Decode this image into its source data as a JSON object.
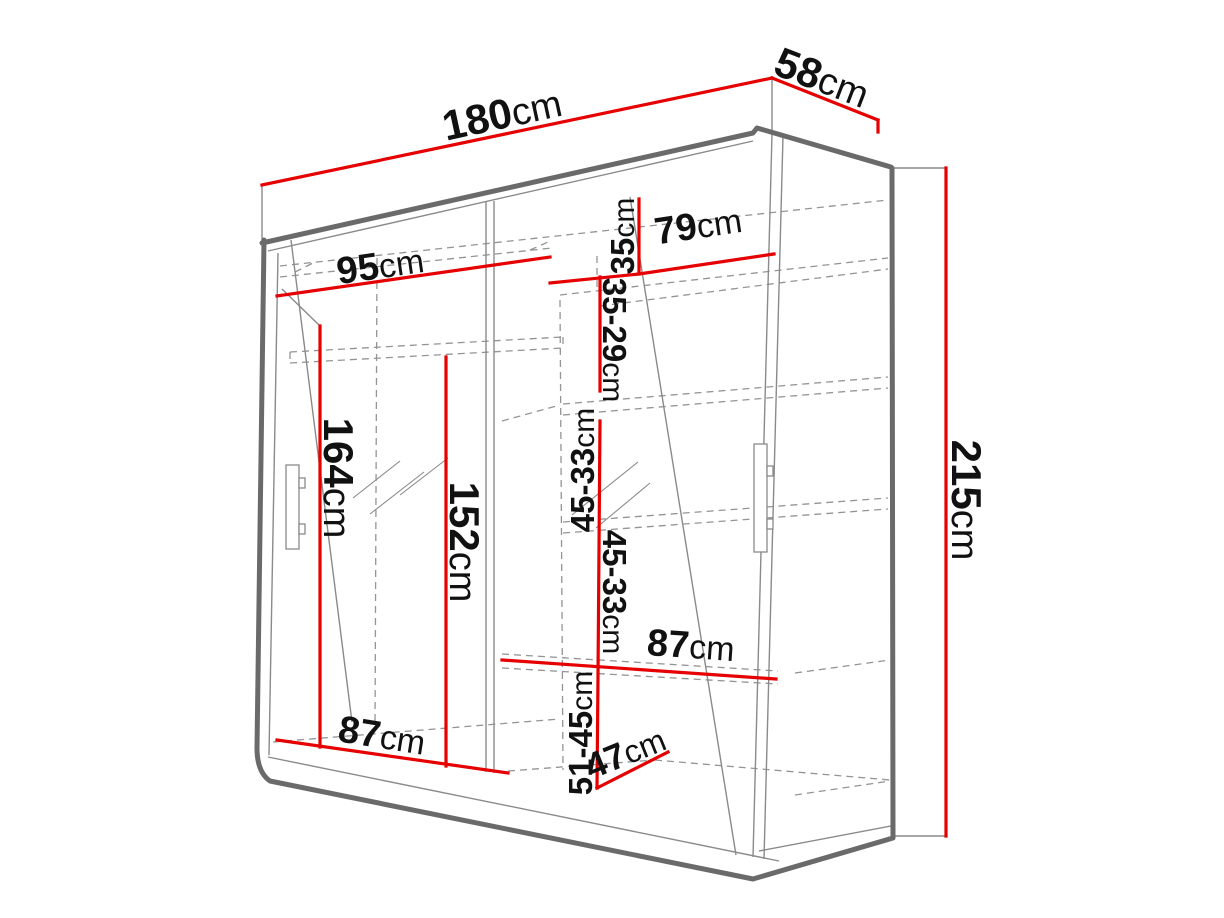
{
  "diagram": {
    "kind": "wardrobe-dimension-drawing",
    "description": "Perspective line drawing of a sliding-door wardrobe with red dimension lines",
    "unit": "cm"
  },
  "colors": {
    "dimension_line": "#e60000",
    "outline_thick": "#6a6a6a",
    "outline_thin": "#8a8a8a",
    "hidden_dashed": "#949494",
    "label_text": "#111111",
    "background": "#ffffff"
  },
  "dims": {
    "width": {
      "num": "180",
      "unit": "cm"
    },
    "depth": {
      "num": "58",
      "unit": "cm"
    },
    "height": {
      "num": "215",
      "unit": "cm"
    },
    "left_top_width": {
      "num": "95",
      "unit": "cm"
    },
    "right_top_width": {
      "num": "79",
      "unit": "cm"
    },
    "top_shelf": {
      "num": "35",
      "unit": "cm"
    },
    "shelf_range_1": {
      "num": "35-29",
      "unit": "cm"
    },
    "shelf_range_2": {
      "num": "45-33",
      "unit": "cm"
    },
    "shelf_range_3": {
      "num": "45-33",
      "unit": "cm"
    },
    "shelf_range_4": {
      "num": "51-45",
      "unit": "cm"
    },
    "hang_height_left": {
      "num": "164",
      "unit": "cm"
    },
    "hang_height_mid": {
      "num": "152",
      "unit": "cm"
    },
    "right_mid_width": {
      "num": "87",
      "unit": "cm"
    },
    "left_bottom_width": {
      "num": "87",
      "unit": "cm"
    },
    "bottom_depth": {
      "num": "47",
      "unit": "cm"
    }
  }
}
